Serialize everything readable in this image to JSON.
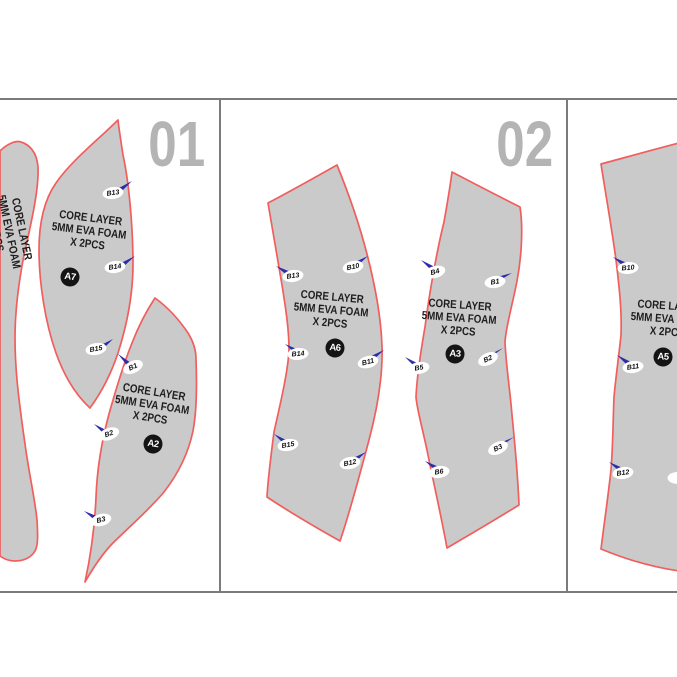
{
  "colors": {
    "piece_fill": "#cacaca",
    "piece_outline": "#f15e5e",
    "grid_line": "#7b7b7b",
    "section_number": "#b4b4b4",
    "notch_dart": "#2d2da8",
    "badge_background": "#141414",
    "label_text": "#1e1e1e"
  },
  "sections": [
    {
      "number": "01",
      "pieces": [
        {
          "name": "side-strip",
          "label_lines": [
            "CORE LAYER",
            "5MM EVA FOAM",
            "X 2PCS"
          ],
          "badge": "",
          "markers": []
        },
        {
          "name": "panel-A7",
          "label_lines": [
            "CORE LAYER",
            "5MM EVA FOAM",
            "X 2PCS"
          ],
          "badge": "A7",
          "markers": [
            "B13",
            "B14",
            "B15"
          ]
        },
        {
          "name": "panel-A2",
          "label_lines": [
            "CORE LAYER",
            "5MM EVA FOAM",
            "X 2PCS"
          ],
          "badge": "A2",
          "markers": [
            "B1",
            "B2",
            "B3"
          ]
        }
      ]
    },
    {
      "number": "02",
      "pieces": [
        {
          "name": "panel-A6",
          "label_lines": [
            "CORE LAYER",
            "5MM EVA FOAM",
            "X 2PCS"
          ],
          "badge": "A6",
          "markers": [
            "B13",
            "B10",
            "B14",
            "B11",
            "B15",
            "B12"
          ]
        },
        {
          "name": "panel-A3",
          "label_lines": [
            "CORE LAYER",
            "5MM EVA FOAM",
            "X 2PCS"
          ],
          "badge": "A3",
          "markers": [
            "B4",
            "B1",
            "B5",
            "B2",
            "B6",
            "B3"
          ]
        }
      ]
    },
    {
      "number": "",
      "pieces": [
        {
          "name": "panel-A5",
          "label_lines": [
            "CORE LAYER",
            "5MM EVA FOAM",
            "X 2PCS"
          ],
          "badge": "A5",
          "markers": [
            "B10",
            "B11",
            "B12"
          ]
        }
      ]
    }
  ]
}
